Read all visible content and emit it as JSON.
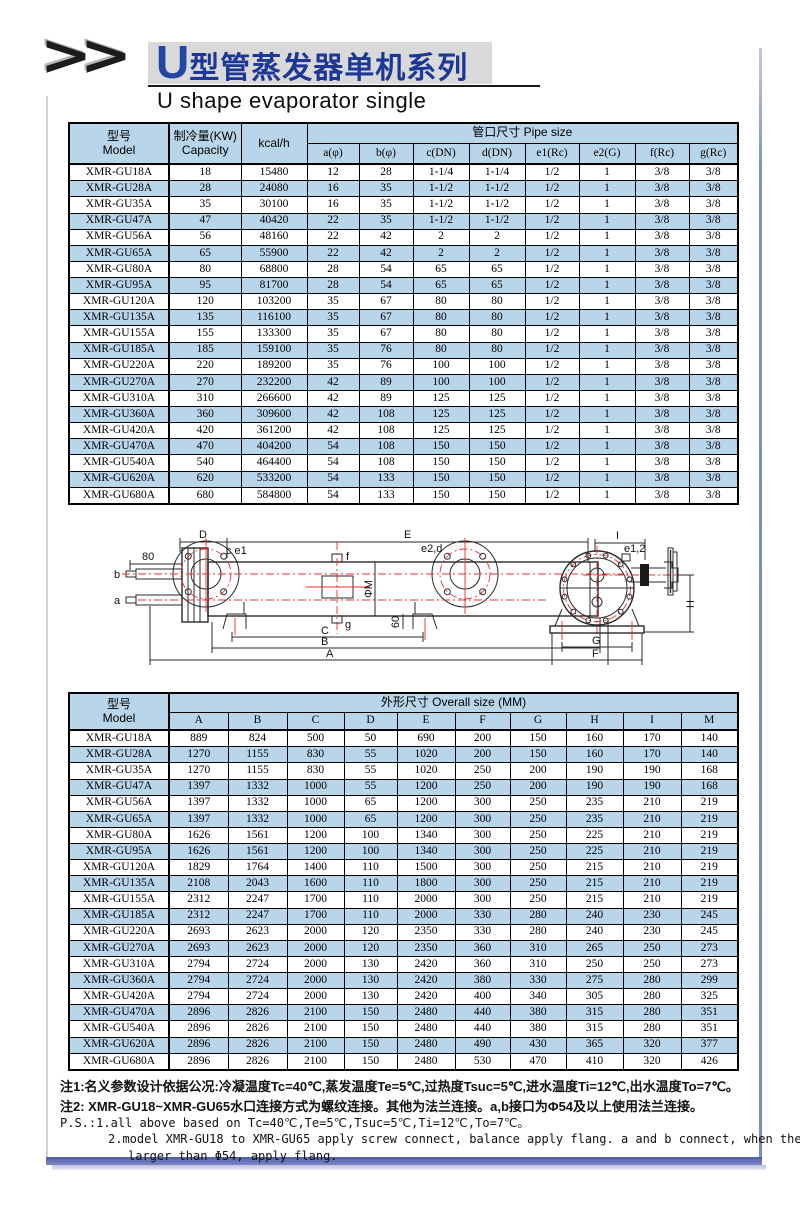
{
  "header": {
    "chevrons": ">>",
    "title_u": "U",
    "title_cn": "型管蒸发器单机系列",
    "subtitle": "U shape evaporator single"
  },
  "colors": {
    "accent_blue": "#b9d5ea",
    "title_blue": "#1c3796",
    "frame_purple": "#7e88c6",
    "red_centerline": "#e53030"
  },
  "pipe_table": {
    "header": {
      "model_cn": "型号",
      "model_en": "Model",
      "capacity_cn": "制冷量(KW)",
      "capacity_en": "Capacity",
      "kcal": "kcal/h",
      "group": "管口尺寸 Pipe size",
      "columns": [
        "a(φ)",
        "b(φ)",
        "c(DN)",
        "d(DN)",
        "e1(Rc)",
        "e2(G)",
        "f(Rc)",
        "g(Rc)"
      ]
    },
    "rows": [
      [
        "XMR-GU18A",
        "18",
        "15480",
        "12",
        "28",
        "1-1/4",
        "1-1/4",
        "1/2",
        "1",
        "3/8",
        "3/8"
      ],
      [
        "XMR-GU28A",
        "28",
        "24080",
        "16",
        "35",
        "1-1/2",
        "1-1/2",
        "1/2",
        "1",
        "3/8",
        "3/8"
      ],
      [
        "XMR-GU35A",
        "35",
        "30100",
        "16",
        "35",
        "1-1/2",
        "1-1/2",
        "1/2",
        "1",
        "3/8",
        "3/8"
      ],
      [
        "XMR-GU47A",
        "47",
        "40420",
        "22",
        "35",
        "1-1/2",
        "1-1/2",
        "1/2",
        "1",
        "3/8",
        "3/8"
      ],
      [
        "XMR-GU56A",
        "56",
        "48160",
        "22",
        "42",
        "2",
        "2",
        "1/2",
        "1",
        "3/8",
        "3/8"
      ],
      [
        "XMR-GU65A",
        "65",
        "55900",
        "22",
        "42",
        "2",
        "2",
        "1/2",
        "1",
        "3/8",
        "3/8"
      ],
      [
        "XMR-GU80A",
        "80",
        "68800",
        "28",
        "54",
        "65",
        "65",
        "1/2",
        "1",
        "3/8",
        "3/8"
      ],
      [
        "XMR-GU95A",
        "95",
        "81700",
        "28",
        "54",
        "65",
        "65",
        "1/2",
        "1",
        "3/8",
        "3/8"
      ],
      [
        "XMR-GU120A",
        "120",
        "103200",
        "35",
        "67",
        "80",
        "80",
        "1/2",
        "1",
        "3/8",
        "3/8"
      ],
      [
        "XMR-GU135A",
        "135",
        "116100",
        "35",
        "67",
        "80",
        "80",
        "1/2",
        "1",
        "3/8",
        "3/8"
      ],
      [
        "XMR-GU155A",
        "155",
        "133300",
        "35",
        "67",
        "80",
        "80",
        "1/2",
        "1",
        "3/8",
        "3/8"
      ],
      [
        "XMR-GU185A",
        "185",
        "159100",
        "35",
        "76",
        "80",
        "80",
        "1/2",
        "1",
        "3/8",
        "3/8"
      ],
      [
        "XMR-GU220A",
        "220",
        "189200",
        "35",
        "76",
        "100",
        "100",
        "1/2",
        "1",
        "3/8",
        "3/8"
      ],
      [
        "XMR-GU270A",
        "270",
        "232200",
        "42",
        "89",
        "100",
        "100",
        "1/2",
        "1",
        "3/8",
        "3/8"
      ],
      [
        "XMR-GU310A",
        "310",
        "266600",
        "42",
        "89",
        "125",
        "125",
        "1/2",
        "1",
        "3/8",
        "3/8"
      ],
      [
        "XMR-GU360A",
        "360",
        "309600",
        "42",
        "108",
        "125",
        "125",
        "1/2",
        "1",
        "3/8",
        "3/8"
      ],
      [
        "XMR-GU420A",
        "420",
        "361200",
        "42",
        "108",
        "125",
        "125",
        "1/2",
        "1",
        "3/8",
        "3/8"
      ],
      [
        "XMR-GU470A",
        "470",
        "404200",
        "54",
        "108",
        "150",
        "150",
        "1/2",
        "1",
        "3/8",
        "3/8"
      ],
      [
        "XMR-GU540A",
        "540",
        "464400",
        "54",
        "108",
        "150",
        "150",
        "1/2",
        "1",
        "3/8",
        "3/8"
      ],
      [
        "XMR-GU620A",
        "620",
        "533200",
        "54",
        "133",
        "150",
        "150",
        "1/2",
        "1",
        "3/8",
        "3/8"
      ],
      [
        "XMR-GU680A",
        "680",
        "584800",
        "54",
        "133",
        "150",
        "150",
        "1/2",
        "1",
        "3/8",
        "3/8"
      ]
    ]
  },
  "size_table": {
    "header": {
      "model_cn": "型号",
      "model_en": "Model",
      "group": "外形尺寸 Overall size (MM)",
      "columns": [
        "A",
        "B",
        "C",
        "D",
        "E",
        "F",
        "G",
        "H",
        "I",
        "M"
      ]
    },
    "rows": [
      [
        "XMR-GU18A",
        "889",
        "824",
        "500",
        "50",
        "690",
        "200",
        "150",
        "160",
        "170",
        "140"
      ],
      [
        "XMR-GU28A",
        "1270",
        "1155",
        "830",
        "55",
        "1020",
        "200",
        "150",
        "160",
        "170",
        "140"
      ],
      [
        "XMR-GU35A",
        "1270",
        "1155",
        "830",
        "55",
        "1020",
        "250",
        "200",
        "190",
        "190",
        "168"
      ],
      [
        "XMR-GU47A",
        "1397",
        "1332",
        "1000",
        "55",
        "1200",
        "250",
        "200",
        "190",
        "190",
        "168"
      ],
      [
        "XMR-GU56A",
        "1397",
        "1332",
        "1000",
        "65",
        "1200",
        "300",
        "250",
        "235",
        "210",
        "219"
      ],
      [
        "XMR-GU65A",
        "1397",
        "1332",
        "1000",
        "65",
        "1200",
        "300",
        "250",
        "235",
        "210",
        "219"
      ],
      [
        "XMR-GU80A",
        "1626",
        "1561",
        "1200",
        "100",
        "1340",
        "300",
        "250",
        "225",
        "210",
        "219"
      ],
      [
        "XMR-GU95A",
        "1626",
        "1561",
        "1200",
        "100",
        "1340",
        "300",
        "250",
        "225",
        "210",
        "219"
      ],
      [
        "XMR-GU120A",
        "1829",
        "1764",
        "1400",
        "110",
        "1500",
        "300",
        "250",
        "215",
        "210",
        "219"
      ],
      [
        "XMR-GU135A",
        "2108",
        "2043",
        "1600",
        "110",
        "1800",
        "300",
        "250",
        "215",
        "210",
        "219"
      ],
      [
        "XMR-GU155A",
        "2312",
        "2247",
        "1700",
        "110",
        "2000",
        "300",
        "250",
        "215",
        "210",
        "219"
      ],
      [
        "XMR-GU185A",
        "2312",
        "2247",
        "1700",
        "110",
        "2000",
        "330",
        "280",
        "240",
        "230",
        "245"
      ],
      [
        "XMR-GU220A",
        "2693",
        "2623",
        "2000",
        "120",
        "2350",
        "330",
        "280",
        "240",
        "230",
        "245"
      ],
      [
        "XMR-GU270A",
        "2693",
        "2623",
        "2000",
        "120",
        "2350",
        "360",
        "310",
        "265",
        "250",
        "273"
      ],
      [
        "XMR-GU310A",
        "2794",
        "2724",
        "2000",
        "130",
        "2420",
        "360",
        "310",
        "250",
        "250",
        "273"
      ],
      [
        "XMR-GU360A",
        "2794",
        "2724",
        "2000",
        "130",
        "2420",
        "380",
        "330",
        "275",
        "280",
        "299"
      ],
      [
        "XMR-GU420A",
        "2794",
        "2724",
        "2000",
        "130",
        "2420",
        "400",
        "340",
        "305",
        "280",
        "325"
      ],
      [
        "XMR-GU470A",
        "2896",
        "2826",
        "2100",
        "150",
        "2480",
        "440",
        "380",
        "315",
        "280",
        "351"
      ],
      [
        "XMR-GU540A",
        "2896",
        "2826",
        "2100",
        "150",
        "2480",
        "440",
        "380",
        "315",
        "280",
        "351"
      ],
      [
        "XMR-GU620A",
        "2896",
        "2826",
        "2100",
        "150",
        "2480",
        "490",
        "430",
        "365",
        "320",
        "377"
      ],
      [
        "XMR-GU680A",
        "2896",
        "2826",
        "2100",
        "150",
        "2480",
        "530",
        "470",
        "410",
        "320",
        "426"
      ]
    ]
  },
  "diagram": {
    "side_view": {
      "dim_d": "D",
      "dim_e": "E",
      "dim_80": "80",
      "port_b": "b",
      "port_a": "a",
      "label_ce1": "c e1",
      "label_f": "f",
      "label_e2d": "e2,d",
      "label_phi_m": "ΦM",
      "label_g": "g",
      "dim_60": "60",
      "dim_c": "C",
      "dim_b": "B",
      "dim_a": "A"
    },
    "end_view": {
      "dim_i": "I",
      "label_e12": "e1,2",
      "dim_h": "H",
      "dim_g": "G",
      "dim_f": "F"
    }
  },
  "notes": {
    "line1": "注1:名义参数设计依据公况:冷凝温度Tc=40℃,蒸发温度Te=5℃,过热度Tsuc=5℃,进水温度Ti=12℃,出水温度To=7℃。",
    "line2": "注2: XMR-GU18~XMR-GU65水口连接方式为螺纹连接。其他为法兰连接。a,b接口为Φ54及以上使用法兰连接。",
    "line3": "P.S.:1.all above based on Tc=40℃,Te=5℃,Tsuc=5℃,Ti=12℃,To=7℃。",
    "line4": "2.model XMR-GU18 to XMR-GU65 apply screw connect, balance apply flang. a and b connect, when the size is",
    "line5": "larger than Φ54, apply flang."
  }
}
